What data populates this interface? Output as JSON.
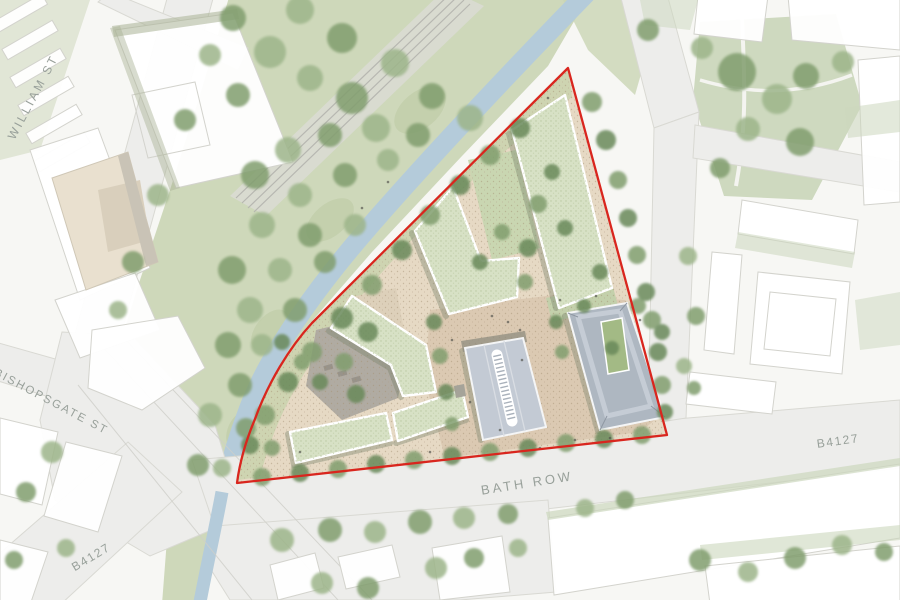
{
  "plan": {
    "description": "Architectural masterplan site plan with red line site boundary",
    "street_labels": {
      "william_st": "WILLIAM ST",
      "bishopsgate_st": "BISHOPSGATE ST",
      "bath_row": "BATH ROW",
      "b4127_east": "B4127",
      "b4127_southwest": "B4127"
    },
    "colors": {
      "site_boundary_red": "#d9261e",
      "canal_blue": "#b4cbda",
      "green_roof": "#d7e1c5",
      "slate_roof": "#b2bac4",
      "vegetation_green": "#86a272",
      "plaza_beige": "#dbc9b2",
      "road_grey": "#ededeb",
      "background": "#f7f7f4",
      "label_text": "#98a09a"
    }
  }
}
